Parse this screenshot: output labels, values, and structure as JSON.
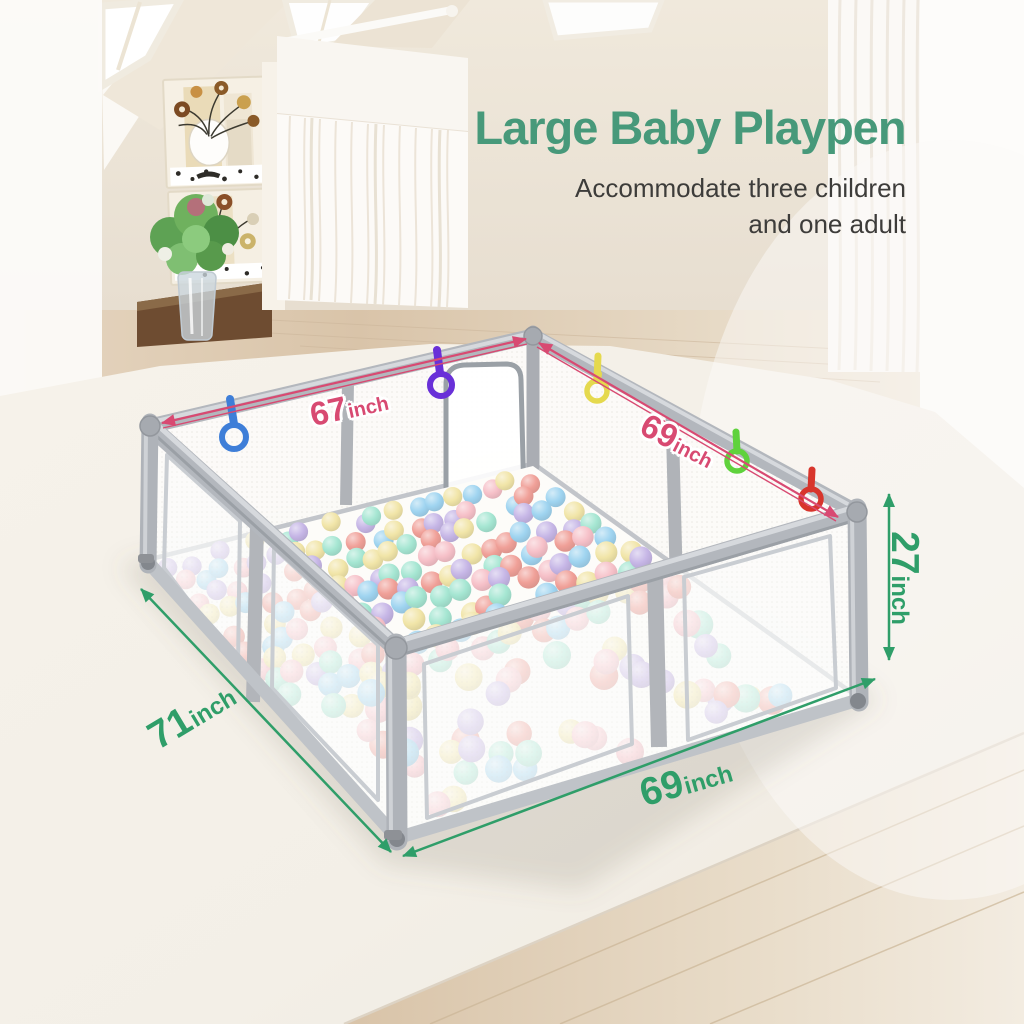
{
  "header": {
    "title": "Large Baby Playpen",
    "subtitle_lines": [
      "Accommodate three children",
      "and one adult"
    ]
  },
  "dimension_labels": {
    "top_back_left": {
      "value": "67",
      "unit": "inch",
      "color": "#d84a72"
    },
    "top_back_right": {
      "value": "69",
      "unit": "inch",
      "color": "#d84a72"
    },
    "side_height": {
      "value": "27",
      "unit": "inch",
      "color": "#2f9e69"
    },
    "floor_front_left": {
      "value": "71",
      "unit": "inch",
      "color": "#2f9e69"
    },
    "floor_front_right": {
      "value": "69",
      "unit": "inch",
      "color": "#2f9e69"
    }
  },
  "product": {
    "name": "large baby playpen with mesh walls and pastel ball pit",
    "frame_color": "#b3b7bd",
    "mesh_color": "#fcfbf9",
    "pull_rings": [
      {
        "color_name": "blue",
        "hex": "#3e7ed8"
      },
      {
        "color_name": "purple",
        "hex": "#6930d8"
      },
      {
        "color_name": "yellow",
        "hex": "#e5d94e"
      },
      {
        "color_name": "green",
        "hex": "#5fd23c"
      },
      {
        "color_name": "red",
        "hex": "#d8352c"
      }
    ],
    "ball_colors": [
      "#a5e6d2",
      "#9fd4f0",
      "#f6c0c8",
      "#f0a098",
      "#f1e5a8",
      "#c6b6e6"
    ]
  },
  "scene": {
    "accent_pink": "#d84a72",
    "accent_green": "#2f9e69",
    "title_green": "#47997a",
    "wall_color": "#ece4d6",
    "wood_color": "#dcc8ad",
    "mat_color": "#f4f0e8"
  }
}
